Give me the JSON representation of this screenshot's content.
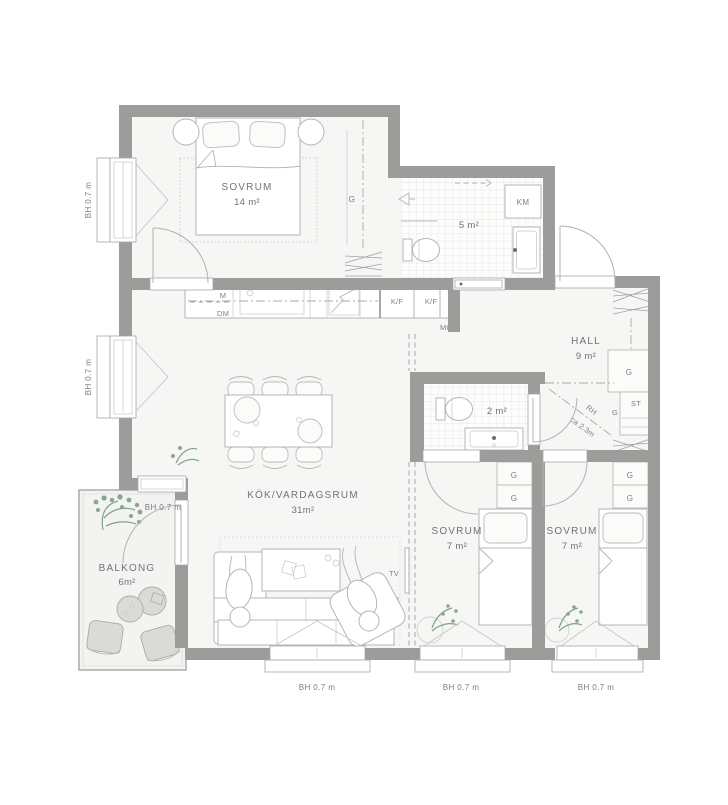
{
  "plan_type": "apartment-floor-plan",
  "rooms": {
    "bedroom_main": {
      "name": "SOVRUM",
      "area": "14 m²"
    },
    "bathroom_large": {
      "area": "5 m²"
    },
    "hall": {
      "name": "HALL",
      "area": "9 m²"
    },
    "kitchen_living": {
      "name": "KÖK/VARDAGSRUM",
      "area": "31m²"
    },
    "bathroom_small": {
      "area": "2 m²"
    },
    "balcony": {
      "name": "BALKONG",
      "area": "6m²"
    },
    "bedroom_left": {
      "name": "SOVRUM",
      "area": "7 m²"
    },
    "bedroom_right": {
      "name": "SOVRUM",
      "area": "7 m²"
    }
  },
  "labels": {
    "wardrobe": "G",
    "cleaning_closet": "ST",
    "washing_machine": "KM",
    "microwave": "M",
    "dishwasher": "DM",
    "fridge_freezer": "K/F",
    "meter_cabinet": "MC",
    "tv": "TV",
    "window_height": "BH 0.7 m",
    "ceiling_height_prefix": "RH",
    "ceiling_height_value": "ca 2.3m"
  },
  "colors": {
    "wall": "#9c9c9b",
    "floor": "#f6f6f5",
    "line": "#b3b6b3",
    "text": "#6f7473",
    "plant": "#7ea287"
  }
}
